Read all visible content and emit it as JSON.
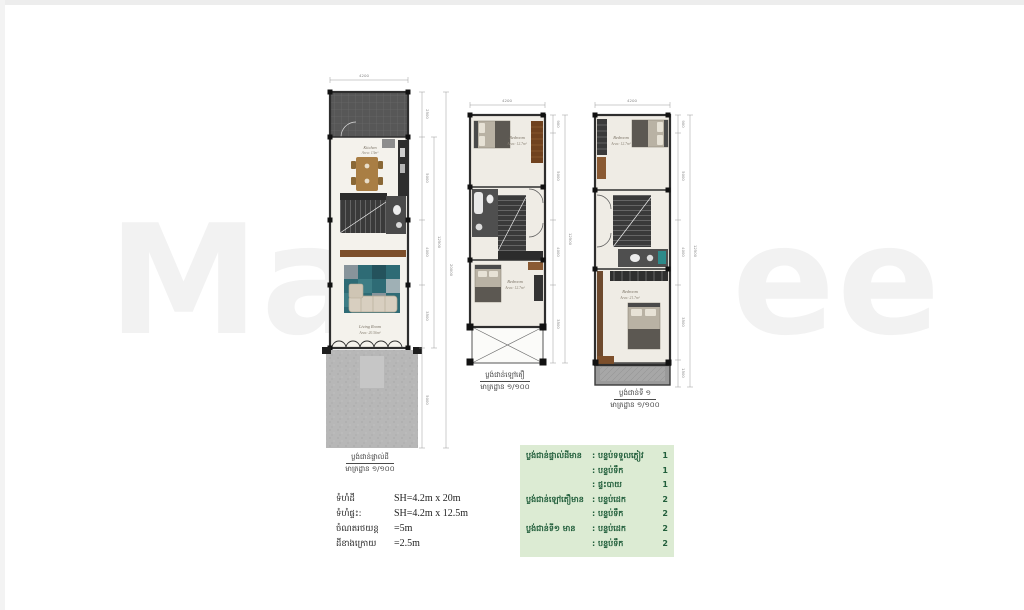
{
  "watermark": {
    "left": "Ma",
    "right": "ee"
  },
  "plans": [
    {
      "top_dim": "4200",
      "right_dims": [
        "2500",
        "5000",
        "4000",
        "3500",
        "5000"
      ],
      "total_dims": [
        "12500",
        "20000"
      ],
      "rooms": [
        {
          "name": "Kitchen",
          "area": "Area: 13m²"
        },
        {
          "name": "Living Room",
          "area": "Area: 20.56m²"
        }
      ],
      "caption_line1": "ប្លង់ជាន់ផ្ទាល់ដី",
      "caption_line2": "មាត្រដ្ឋាន ១/១០០"
    },
    {
      "top_dim": "4200",
      "right_dims": [
        "900",
        "5000",
        "4000",
        "3500"
      ],
      "total_dims": [
        "12500"
      ],
      "rooms": [
        {
          "name": "Bedroom",
          "area": "Area: 12.7m²"
        },
        {
          "name": "Bedroom",
          "area": "Area: 12.7m²"
        }
      ],
      "caption_line1": "ប្លង់ជាន់ឡៅតឿ",
      "caption_line2": "មាត្រដ្ឋាន ១/១០០"
    },
    {
      "top_dim": "4200",
      "right_dims": [
        "900",
        "5000",
        "4000",
        "3500",
        "1500"
      ],
      "total_dims": [
        "12500"
      ],
      "rooms": [
        {
          "name": "Bedroom",
          "area": "Area: 12.7m²"
        },
        {
          "name": "Bedroom",
          "area": "Area: 21.7m²"
        }
      ],
      "caption_line1": "ប្លង់ជាន់ទី ១",
      "caption_line2": "មាត្រដ្ឋាន ១/១០០"
    }
  ],
  "specs": {
    "rows": [
      {
        "label": "ទំហំដី",
        "value": "SH=4.2m x 20m"
      },
      {
        "label": "ទំហំផ្ទះ:",
        "value": "SH=4.2m x 12.5m"
      },
      {
        "label": "ចំណតរថយន្ត",
        "value": "=5m"
      },
      {
        "label": "ដីខាងក្រោយ",
        "value": "=2.5m"
      }
    ]
  },
  "summary_table": {
    "bg_color": "#dcebd3",
    "text_color": "#215e3b",
    "rows": [
      {
        "floor": "ប្លង់ជាន់ផ្ទាល់ដីមាន",
        "item": ": បន្ទប់ទទួលភ្ញៀវ",
        "count": "1"
      },
      {
        "floor": "",
        "item": ": បន្ទប់ទឹក",
        "count": "1"
      },
      {
        "floor": "",
        "item": ": ផ្ទះបាយ",
        "count": "1"
      },
      {
        "floor": "ប្លង់ជាន់ឡៅតឿមាន",
        "item": ": បន្ទប់ដេក",
        "count": "2"
      },
      {
        "floor": "",
        "item": ": បន្ទប់ទឹក",
        "count": "2"
      },
      {
        "floor": "ប្លង់ជាន់ទី១ មាន",
        "item": ": បន្ទប់ដេក",
        "count": "2"
      },
      {
        "floor": "",
        "item": ": បន្ទប់ទឹក",
        "count": "2"
      }
    ]
  }
}
